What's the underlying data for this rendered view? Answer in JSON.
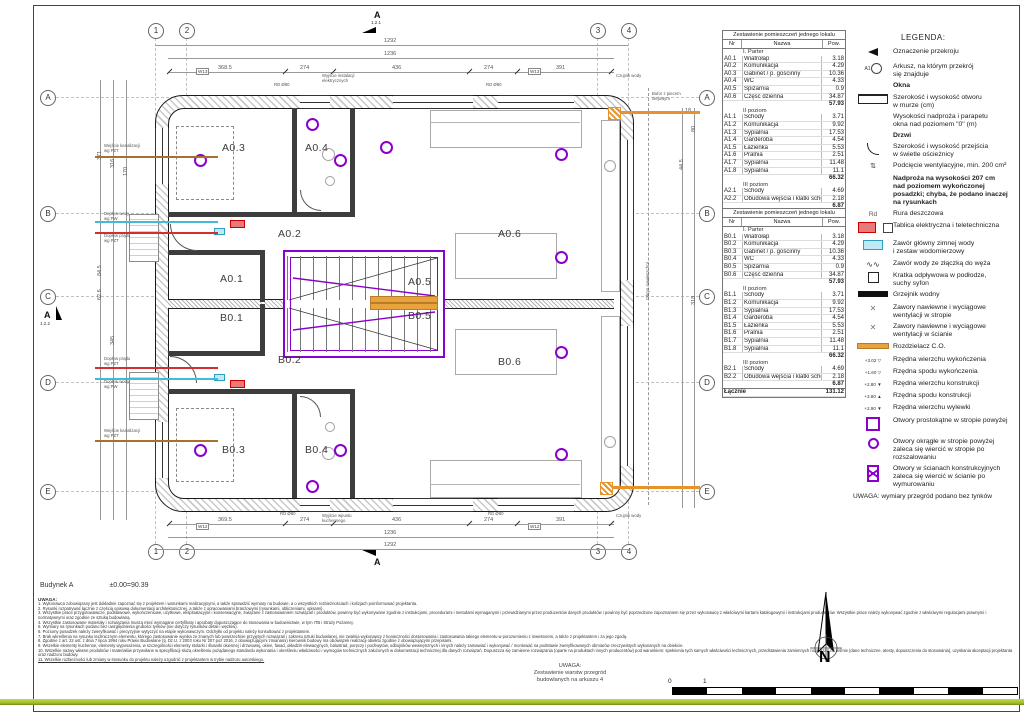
{
  "meta": {
    "building": "Budynek A",
    "datum": "±0.00=90.39"
  },
  "grid": {
    "cols": [
      "1",
      "2",
      "3",
      "4"
    ],
    "rows": [
      "A",
      "B",
      "C",
      "D",
      "E"
    ]
  },
  "sections": {
    "top_label": "A",
    "top_sheet": "1.2.1",
    "side_label": "A",
    "side_sheet": "1.2.2",
    "bottom_label": "A"
  },
  "plan": {
    "rooms": {
      "a01": "A0.1",
      "a02": "A0.2",
      "a03": "A0.3",
      "a04": "A0.4",
      "a05": "A0.5",
      "a06": "A0.6",
      "b01": "B0.1",
      "b02": "B0.2",
      "b03": "B0.3",
      "b04": "B0.4",
      "b05": "B0.5",
      "b06": "B0.6"
    },
    "annotations": {
      "w13": "W13",
      "w12": "W12",
      "rd80": "RD Ø80",
      "elec_out": "Wyjście instalacji\nelektrycznych",
      "kitchen_out": "Wyjście wpustu\nkuchennego",
      "water_sensor": "Czujnik wody",
      "buffer": "Bufor z piecem\nolejowym",
      "pavement": "Obrys nawierzchni",
      "sewer_in": "Wejście kanalizacji\nwg PZT",
      "cold_water": "Dopływ wody\nwg PW",
      "power_in": "Dopływ prądu\nwg PZT"
    }
  },
  "dims": {
    "top_total": "1292",
    "inner": "1236",
    "segs": [
      "368.5",
      "274",
      "436",
      "274",
      "391"
    ],
    "segs_b": [
      "369.5",
      "274",
      "436",
      "274",
      "391"
    ],
    "left": [
      "371",
      "316",
      "170",
      "84.5",
      "62.6",
      "345"
    ],
    "right": [
      "18",
      "80",
      "44.5",
      "318"
    ]
  },
  "tables": {
    "title": "Zestawienie pomieszczeń jednego lokalu",
    "headers": [
      "Nr",
      "Nazwa",
      "Pow."
    ],
    "a_rows": [
      {
        "nr": "",
        "name": "I. Parter",
        "pow": "",
        "cls": "sec"
      },
      {
        "nr": "A0.1",
        "name": "Wiatrołap",
        "pow": "3.18"
      },
      {
        "nr": "A0.2",
        "name": "Komunikacja",
        "pow": "4.29"
      },
      {
        "nr": "A0.3",
        "name": "Gabinet / p. gościnny",
        "pow": "10.36"
      },
      {
        "nr": "A0.4",
        "name": "WC",
        "pow": "4.33"
      },
      {
        "nr": "A0.5",
        "name": "Spiżarnia",
        "pow": "0.9"
      },
      {
        "nr": "A0.6",
        "name": "Część dzienna",
        "pow": "34.87"
      },
      {
        "nr": "",
        "name": "",
        "pow": "57.93",
        "cls": "sum"
      },
      {
        "nr": "",
        "name": "II poziom",
        "pow": "",
        "cls": "sec"
      },
      {
        "nr": "A1.1",
        "name": "Schody",
        "pow": "3.71"
      },
      {
        "nr": "A1.2",
        "name": "Komunikacja",
        "pow": "9.92"
      },
      {
        "nr": "A1.3",
        "name": "Sypialnia",
        "pow": "17.53"
      },
      {
        "nr": "A1.4",
        "name": "Garderoba",
        "pow": "4.54"
      },
      {
        "nr": "A1.5",
        "name": "Łazienka",
        "pow": "5.53"
      },
      {
        "nr": "A1.6",
        "name": "Pralnia",
        "pow": "2.51"
      },
      {
        "nr": "A1.7",
        "name": "Sypialnia",
        "pow": "11.48"
      },
      {
        "nr": "A1.8",
        "name": "Sypialnia",
        "pow": "11.1"
      },
      {
        "nr": "",
        "name": "",
        "pow": "66.32",
        "cls": "sum"
      },
      {
        "nr": "",
        "name": "III poziom",
        "pow": "",
        "cls": "sec"
      },
      {
        "nr": "A2.1",
        "name": "Schody",
        "pow": "4.69"
      },
      {
        "nr": "A2.2",
        "name": "Obudowa wejścia i klatki schodowej",
        "pow": "2.18"
      },
      {
        "nr": "",
        "name": "",
        "pow": "6.87",
        "cls": "sum"
      },
      {
        "nr": "Łącznie",
        "name": "",
        "pow": "131.12",
        "cls": "total"
      }
    ],
    "b_rows": [
      {
        "nr": "",
        "name": "I. Parter",
        "pow": "",
        "cls": "sec"
      },
      {
        "nr": "B0.1",
        "name": "Wiatrołap",
        "pow": "3.18"
      },
      {
        "nr": "B0.2",
        "name": "Komunikacja",
        "pow": "4.29"
      },
      {
        "nr": "B0.3",
        "name": "Gabinet / p. gościnny",
        "pow": "10.36"
      },
      {
        "nr": "B0.4",
        "name": "WC",
        "pow": "4.33"
      },
      {
        "nr": "B0.5",
        "name": "Spiżarnia",
        "pow": "0.9"
      },
      {
        "nr": "B0.6",
        "name": "Część dzienna",
        "pow": "34.87"
      },
      {
        "nr": "",
        "name": "",
        "pow": "57.93",
        "cls": "sum"
      },
      {
        "nr": "",
        "name": "II poziom",
        "pow": "",
        "cls": "sec"
      },
      {
        "nr": "B1.1",
        "name": "Schody",
        "pow": "3.71"
      },
      {
        "nr": "B1.2",
        "name": "Komunikacja",
        "pow": "9.92"
      },
      {
        "nr": "B1.3",
        "name": "Sypialnia",
        "pow": "17.53"
      },
      {
        "nr": "B1.4",
        "name": "Garderoba",
        "pow": "4.54"
      },
      {
        "nr": "B1.5",
        "name": "Łazienka",
        "pow": "5.53"
      },
      {
        "nr": "B1.6",
        "name": "Pralnia",
        "pow": "2.51"
      },
      {
        "nr": "B1.7",
        "name": "Sypialnia",
        "pow": "11.48"
      },
      {
        "nr": "B1.8",
        "name": "Sypialnia",
        "pow": "11.1"
      },
      {
        "nr": "",
        "name": "",
        "pow": "66.32",
        "cls": "sum"
      },
      {
        "nr": "",
        "name": "III poziom",
        "pow": "",
        "cls": "sec"
      },
      {
        "nr": "B2.1",
        "name": "Schody",
        "pow": "4.69"
      },
      {
        "nr": "B2.2",
        "name": "Obudowa wejścia i klatki schodowej",
        "pow": "2.18"
      },
      {
        "nr": "",
        "name": "",
        "pow": "6.87",
        "cls": "sum"
      },
      {
        "nr": "Łącznie",
        "name": "",
        "pow": "131.12",
        "cls": "total"
      }
    ]
  },
  "legend": {
    "title": "LEGENDA:",
    "items": [
      {
        "icon": "section-mark-icon",
        "icon_label": "",
        "text": "Oznaczenie przekroju"
      },
      {
        "icon": "sheet-ref-icon",
        "icon_label": "A1",
        "text": "Arkusz, na którym przekrój\nsię znajduje"
      },
      {
        "icon": "",
        "icon_label": "",
        "text": "Okna",
        "cls": "bold"
      },
      {
        "icon": "window-icon",
        "icon_label": "",
        "text": "Szerokość i wysokość otworu\nw murze  (cm)"
      },
      {
        "icon": "",
        "icon_label": "",
        "text": "Wysokości nadproża i parapetu\nokna nad poziomem \"0\"  (m)"
      },
      {
        "icon": "",
        "icon_label": "",
        "text": "Drzwi",
        "cls": "bold"
      },
      {
        "icon": "door-icon",
        "icon_label": "",
        "text": "Szerokość i wysokość przejścia\nw świetle ościeżnicy"
      },
      {
        "icon": "vent-undercut-icon",
        "icon_label": "⇅",
        "text": "Podcięcie wentylacyjne, min. 200 cm²"
      },
      {
        "icon": "",
        "icon_label": "",
        "text": "Nadproża na wysokości 207 cm\nnad poziomem wykończonej\nposadzki; chyba, że podano inaczej\nna rysunkach",
        "cls": "bold"
      },
      {
        "icon": "rain-pipe-icon",
        "icon_label": "Rd",
        "text": "Rura deszczowa"
      },
      {
        "icon": "electrical-panel-icon",
        "icon_label": "",
        "text": "Tablica elektryczna i teletechniczna"
      },
      {
        "icon": "water-main-valve-icon",
        "icon_label": "",
        "text": "Zawór główny zimnej wody\ni zestaw wodomierzowy"
      },
      {
        "icon": "hose-valve-icon",
        "icon_label": "∿∿",
        "text": "Zawór wody ze złączką do węża"
      },
      {
        "icon": "floor-drain-icon",
        "icon_label": "",
        "text": "Kratka odpływowa w podłodze,\nsuchy syfon"
      },
      {
        "icon": "radiator-icon",
        "icon_label": "",
        "text": "Grzejnik wodny"
      },
      {
        "icon": "ceiling-vent-icon",
        "icon_label": "✕",
        "text": "Zawory nawiewne i wyciągowe\nwentylacji w stropie"
      },
      {
        "icon": "wall-vent-icon",
        "icon_label": "✕",
        "text": "Zawory nawiewne i wyciągowe\nwentylacji w ścianie"
      },
      {
        "icon": "co-manifold-icon",
        "icon_label": "",
        "text": "Rozdzielacz C.O."
      },
      {
        "icon": "lvl",
        "icon_label": "+3.02 ▽",
        "text": "Rzędna wierzchu wykończenia"
      },
      {
        "icon": "lvl",
        "icon_label": "+1.60 ▽",
        "text": "Rzędna spodu wykończenia"
      },
      {
        "icon": "lvl",
        "icon_label": "+2.80 ▼",
        "text": "Rzędna wierzchu konstrukcji"
      },
      {
        "icon": "lvl",
        "icon_label": "+3.80 ▲",
        "text": "Rzędna spodu konstrukcji"
      },
      {
        "icon": "lvl",
        "icon_label": "+2.90 ▼",
        "text": "Rzędna wierzchu wylewki"
      },
      {
        "icon": "slab-rect-opening-icon",
        "icon_label": "",
        "text": "Otwory prostokątne w stropie powyżej"
      },
      {
        "icon": "slab-round-opening-icon",
        "icon_label": "",
        "text": "Otwory okrągłe w stropie powyżej\nzaleca się wiercić w stropie po\nrozszalowaniu"
      },
      {
        "icon": "wall-opening-icon",
        "icon_label": "",
        "text": "Otwory w ścianach konstrukcyjnych\nzaleca się wiercić w ścianie po\nwymurowaniu"
      }
    ],
    "footer": "UWAGA: wymiary przegród podano bez tynków"
  },
  "notes": {
    "title": "UWAGA:",
    "items": [
      {
        "text": "1. Wykonawca zobowiązany jest dokładnie zapoznać się z projektem i warunkami realizacyjnymi, a także sprawdzić wymiary na budowie, a o wszystkich rozbieżnościach i kolizjach poinformować projektanta."
      },
      {
        "text": "2. Rysunki rozpatrywać łącznie z częścią opisową dokumentacji architektonicznej, a także z opracowaniami branżowymi (rysunkami, obliczeniami, opisami)."
      },
      {
        "text": "3. Wszystkie prace przygotowawcze, podstawowe, wykończeniowe, użytkowe, eksploatacyjne i konserwacyjne, związane z zastosowaniem rozwiązań i produktów, powinny być wykonywane zgodnie z instrukcjami, procedurami i metodami wymaganymi i przewidzianymi przez producentów danych produktów i powinny być poprzedzone zapoznaniem się przez wykonawcę z właściwymi kartami katalogowymi i instrukcjami producentów. Wszystkie prace należy wykonywać zgodnie z właściwymi regulacjami prawnymi i normatywnymi oraz zgodnie ze sztuką budowlaną."
      },
      {
        "text": "4. Wszystkie zastosowane materiały i rozwiązania muszą mieć wymagane certyfikaty i aprobaty dopuszczające do stosowania w budownictwie, w tym ITB i Straży Pożarnej."
      },
      {
        "text": "5. Wymiary na rysunkach podano bez uwzględnienia grubości tynków (nie dotyczy rysunków detali i węzłów)."
      },
      {
        "text": "6. Poziomy posadzek należy zweryfikować i precyzyjnie wytyczyć na etapie wykonawczym. Odchyłki od projektu należy konsultować z projektantem."
      },
      {
        "text": "7. Brak wkreślenia na rysunku technicznym elementu, którego zastosowanie wynika ze znanych lub powszechnie przyjętych rozwiązań i zakresu sztuki budowlanej, nie zwalnia wykonawcy z konieczności dostosowania i zastosowania takiego elementu w porozumieniu z inwestorem, a także z projektantem i za jego zgodą."
      },
      {
        "text": "8. Zgodnie z art. 22 ust. z dnia 7 lipca 1994 roku Prawo Budowlane (tj. Dz.U. z 2003 roku Nr 207 poz 2016, z obowiązującymi zmianami) kierownik budowy ma obowiązek realizacji obiektu zgodnie z obowiązującymi przepisami."
      },
      {
        "text": "9. Wszelkie elementy kuchenne, elementy wyposażenia, w szczególności elementy stolarki i ślusarki okiennej i drzwiowej, okien, fasad, okładzin elewacyjnych, balustrad, poręczy i pochwytów, odbojników wewnętrznych i innych należy zamawiać i wykonywać / montować na podstawie zweryfikowanych obmiarów rzeczywistych wykonanych na obiekcie."
      },
      {
        "text": "10. Wszelkie nazwy własne produktów i materiałów przywołane w specyfikacji służą określeniu pożądanego standardu wykonania i określeniu właściwości i wymogów technicznych założonych w dokumentacji technicznej dla danych rozwiązań. Dopuszcza się zamienne rozwiązania (oparte na produktach innych producentów) pod warunkiem: spełnienia tych samych właściwości technicznych, przedstawienia zamiennych rozwiązań na piśmie (dane techniczne, atesty, dopuszczenia do stosowania), uzyskania akceptacji projektanta oraz nadzoru budowy."
      },
      {
        "text": "11. Wszelkie rozbieżności lub zmiany w stosunku do projektu należy uzgodnić z projektantem w trybie nadzoru autorskiego.",
        "cls": "u"
      }
    ]
  },
  "footer": {
    "center_note": "UWAGA:\nZestawienie warstw przegród\nbudowlanych na arkuszu 4",
    "scale0": "0",
    "scale1": "1",
    "north": "N"
  }
}
